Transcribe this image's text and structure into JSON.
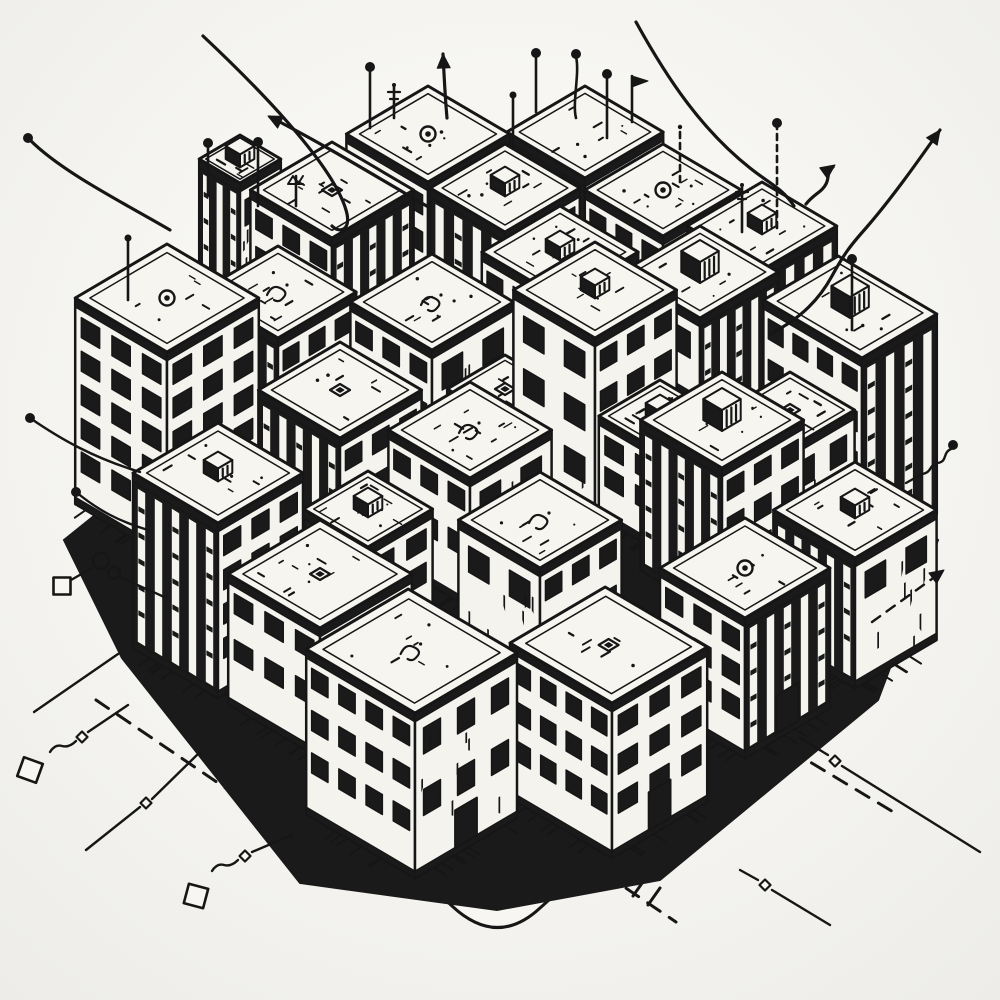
{
  "scene": {
    "label": "hand-drawn isometric city block illustration with antennas, arrows and circuit traces",
    "bg": "#f2f1ed",
    "paper": "#f7f6f2",
    "ink": "#161616",
    "roof": "#f6f5f0",
    "face": "#f4f3ee",
    "dark": "#1a1a1a"
  },
  "iso": {
    "ux": 34,
    "uy": 20
  },
  "ground": {
    "outline": "M 212 424 L 96 520 Q 66 544 84 566 L 452 906 Q 497 948 540 908 L 900 586 Q 928 562 906 538 L 790 430 L 500 300 Z",
    "inner": "M 238 448 L 118 540 Q 98 556 112 570 L 458 886 Q 497 920 534 888 L 876 592 Q 896 570 878 552 L 762 448",
    "mass": "M 500 238 L 706 352 L 938 540 L 878 700 L 660 880 L 497 910 L 300 883 L 122 658 L 64 540 L 298 352 Z",
    "dashes": [
      {
        "d": "M 96 700 L 252 806",
        "w": 3,
        "dash": "15 11"
      },
      {
        "d": "M 128 648 L 188 690",
        "w": 3,
        "dash": "13 10"
      },
      {
        "d": "M 540 830 L 676 922",
        "w": 3,
        "dash": "15 11"
      },
      {
        "d": "M 700 696 L 900 816",
        "w": 3,
        "dash": "15 11"
      },
      {
        "d": "M 212 652 L 468 890",
        "w": 2.6,
        "dash": "18 12"
      },
      {
        "d": "M 806 648 L 532 884",
        "w": 2.6,
        "dash": "18 12"
      },
      {
        "d": "M 452 776 L 486 796",
        "w": 2.6,
        "dash": "9 7"
      },
      {
        "d": "M 462 792 L 496 812",
        "w": 2.6,
        "dash": "9 7"
      }
    ],
    "crosswalk": [
      [
        600,
        852,
        588,
        869
      ],
      [
        615,
        861,
        603,
        878
      ],
      [
        630,
        870,
        618,
        887
      ],
      [
        645,
        879,
        633,
        896
      ],
      [
        660,
        888,
        648,
        905
      ]
    ]
  },
  "buildings": [
    {
      "fx": 428,
      "fy": 332,
      "wa": 2.4,
      "wb": 2.4,
      "h": 150,
      "right": "stripes",
      "left": "grid",
      "roof": "vent",
      "door": false
    },
    {
      "fx": 585,
      "fy": 318,
      "wa": 2.3,
      "wb": 2.3,
      "h": 140,
      "right": "grid",
      "left": "stripes",
      "roof": "none",
      "door": false
    },
    {
      "fx": 240,
      "fy": 303,
      "wa": 1.2,
      "wb": 1.2,
      "h": 120,
      "right": "sparse",
      "left": "stripes",
      "roof": "cube",
      "door": false
    },
    {
      "fx": 332,
      "fy": 388,
      "wa": 2.4,
      "wb": 2.4,
      "h": 150,
      "right": "stripes",
      "left": "grid",
      "roof": "dot",
      "door": false
    },
    {
      "fx": 505,
      "fy": 392,
      "wa": 2.2,
      "wb": 2.2,
      "h": 160,
      "right": "grid",
      "left": "stripes",
      "roof": "cube",
      "door": false
    },
    {
      "fx": 663,
      "fy": 376,
      "wa": 2.3,
      "wb": 2.3,
      "h": 140,
      "right": "sparse",
      "left": "grid",
      "roof": "vent",
      "door": false
    },
    {
      "fx": 762,
      "fy": 420,
      "wa": 2.2,
      "wb": 2.2,
      "h": 150,
      "right": "stripes",
      "left": "stripes",
      "roof": "cube",
      "door": false
    },
    {
      "fx": 167,
      "fy": 558,
      "wa": 2.7,
      "wb": 2.7,
      "h": 206,
      "right": "grid",
      "left": "grid",
      "roof": "vent",
      "door": false
    },
    {
      "fx": 278,
      "fy": 468,
      "wa": 2.3,
      "wb": 2.3,
      "h": 130,
      "right": "grid",
      "left": "stripes",
      "roof": "squiggle",
      "door": false
    },
    {
      "fx": 432,
      "fy": 470,
      "wa": 2.4,
      "wb": 2.4,
      "h": 120,
      "right": "sparse",
      "left": "grid",
      "roof": "squiggle",
      "door": false
    },
    {
      "fx": 560,
      "fy": 448,
      "wa": 2.3,
      "wb": 2.3,
      "h": 150,
      "right": "grid",
      "left": "grid",
      "roof": "cube",
      "door": false
    },
    {
      "fx": 700,
      "fy": 478,
      "wa": 2.3,
      "wb": 2.3,
      "h": 160,
      "right": "stripes",
      "left": "sparse",
      "roof": "cube2",
      "door": false
    },
    {
      "fx": 862,
      "fy": 558,
      "wa": 2.9,
      "wb": 2.2,
      "h": 200,
      "right": "stripes",
      "left": "grid",
      "roof": "cube2",
      "door": false
    },
    {
      "fx": 595,
      "fy": 538,
      "wa": 2.4,
      "wb": 2.4,
      "h": 200,
      "right": "grid",
      "left": "sparse",
      "roof": "cube",
      "door": false
    },
    {
      "fx": 340,
      "fy": 558,
      "wa": 2.4,
      "wb": 2.4,
      "h": 120,
      "right": "grid",
      "left": "stripes",
      "roof": "dot",
      "door": false
    },
    {
      "fx": 470,
      "fy": 608,
      "wa": 2.4,
      "wb": 2.4,
      "h": 130,
      "right": "sparse",
      "left": "grid",
      "roof": "squiggle",
      "door": false
    },
    {
      "fx": 722,
      "fy": 618,
      "wa": 2.4,
      "wb": 2.4,
      "h": 150,
      "right": "grid",
      "left": "stripes",
      "roof": "cube2",
      "door": false
    },
    {
      "fx": 218,
      "fy": 698,
      "wa": 2.5,
      "wb": 2.5,
      "h": 175,
      "right": "grid",
      "left": "stripes",
      "roof": "cube",
      "door": false
    },
    {
      "fx": 320,
      "fy": 758,
      "wa": 2.7,
      "wb": 2.7,
      "h": 130,
      "right": "grid",
      "left": "grid",
      "roof": "dot",
      "door": true
    },
    {
      "fx": 415,
      "fy": 878,
      "wa": 3.2,
      "wb": 3.0,
      "h": 165,
      "right": "sparse",
      "left": "grid",
      "roof": "squiggle",
      "door": true
    },
    {
      "fx": 540,
      "fy": 698,
      "wa": 2.4,
      "wb": 2.4,
      "h": 130,
      "right": "grid",
      "left": "sparse",
      "roof": "squiggle",
      "door": false
    },
    {
      "fx": 612,
      "fy": 858,
      "wa": 3.0,
      "wb": 2.8,
      "h": 155,
      "right": "grid",
      "left": "grid",
      "roof": "dot",
      "door": true
    },
    {
      "fx": 745,
      "fy": 758,
      "wa": 2.5,
      "wb": 2.5,
      "h": 140,
      "right": "stripes",
      "left": "grid",
      "roof": "vent",
      "door": true
    },
    {
      "fx": 855,
      "fy": 688,
      "wa": 2.4,
      "wb": 2.4,
      "h": 130,
      "right": "sparse",
      "left": "stripes",
      "roof": "cube",
      "door": false
    },
    {
      "fx": 660,
      "fy": 552,
      "wa": 1.8,
      "wb": 1.8,
      "h": 100,
      "right": "grid",
      "left": "grid",
      "roof": "cube",
      "door": false
    },
    {
      "fx": 505,
      "fy": 518,
      "wa": 1.7,
      "wb": 1.7,
      "h": 95,
      "right": "stripes",
      "left": "grid",
      "roof": "dot",
      "door": false
    },
    {
      "fx": 368,
      "fy": 652,
      "wa": 1.9,
      "wb": 1.9,
      "h": 105,
      "right": "grid",
      "left": "stripes",
      "roof": "cube",
      "door": false
    },
    {
      "fx": 790,
      "fy": 560,
      "wa": 1.9,
      "wb": 1.9,
      "h": 112,
      "right": "sparse",
      "left": "grid",
      "roof": "dot",
      "door": false
    }
  ],
  "antennas": [
    {
      "x": 370,
      "top": 70,
      "bottom": 128,
      "style": "ball"
    },
    {
      "x": 536,
      "top": 56,
      "bottom": 112,
      "style": "ball"
    },
    {
      "x": 576,
      "top": 57,
      "bottom": 118,
      "style": "ballwave"
    },
    {
      "x": 513,
      "top": 97,
      "bottom": 148,
      "style": "ballsmall"
    },
    {
      "x": 607,
      "top": 77,
      "bottom": 138,
      "style": "ball"
    },
    {
      "x": 680,
      "top": 129,
      "bottom": 182,
      "style": "dash"
    },
    {
      "x": 777,
      "top": 126,
      "bottom": 228,
      "style": "dashball"
    },
    {
      "x": 852,
      "top": 262,
      "bottom": 330,
      "style": "ball"
    },
    {
      "x": 208,
      "top": 146,
      "bottom": 196,
      "style": "ball"
    },
    {
      "x": 258,
      "top": 145,
      "bottom": 206,
      "style": "ball"
    },
    {
      "x": 128,
      "top": 240,
      "bottom": 300,
      "style": "ballsmall"
    },
    {
      "x": 394,
      "top": 86,
      "bottom": 118,
      "style": "cross"
    },
    {
      "x": 632,
      "top": 76,
      "bottom": 122,
      "style": "flag"
    },
    {
      "x": 742,
      "top": 186,
      "bottom": 232,
      "style": "cross"
    },
    {
      "x": 296,
      "top": 176,
      "bottom": 206,
      "style": "tv"
    }
  ],
  "arrows": [
    {
      "d": "M 770 334 C 802 318 820 298 832 276 C 844 254 850 246 866 228 C 892 198 916 164 940 130",
      "head": [
        940,
        130,
        24,
        -34
      ]
    },
    {
      "d": "M 447 118 C 445 96 444 74 443 54",
      "head": [
        443,
        54,
        -1,
        -20
      ]
    },
    {
      "d": "M 430 208 C 382 180 320 142 270 117",
      "head": [
        268,
        116,
        -50,
        -25
      ]
    },
    {
      "d": "M 806 204 C 814 194 822 192 826 184 C 830 176 826 172 833 167",
      "head": [
        835,
        165,
        7,
        -5
      ]
    },
    {
      "d": "M 203 36 C 252 82 332 162 346 210 C 352 230 340 234 332 226",
      "head": null
    },
    {
      "d": "M 636 22 C 668 80 702 130 750 168 C 770 184 782 188 794 206",
      "head": null
    },
    {
      "d": "M 30 140 C 62 172 122 202 170 230",
      "head": null,
      "ball": [
        28,
        138
      ]
    }
  ],
  "traces": {
    "paths": [
      {
        "d": "M 30 418 C 62 440 94 458 140 472"
      },
      {
        "d": "M 76 492 C 98 510 118 521 148 530"
      },
      {
        "d": "M 120 577 C 138 586 150 590 164 597"
      },
      {
        "d": "M 71 580 L 92 568"
      },
      {
        "d": "M 118 654 L 34 712"
      },
      {
        "d": "M 128 705 L 88 732"
      },
      {
        "d": "M 76 741 q -7 7 -14 5 q -7 -2 -12 6"
      },
      {
        "d": "M 200 752 L 152 799"
      },
      {
        "d": "M 140 807 L 86 850"
      },
      {
        "d": "M 292 835 L 252 852"
      },
      {
        "d": "M 238 860 q -7 7 -14 5 q -7 -2 -12 6"
      },
      {
        "d": "M 800 738 L 828 755"
      },
      {
        "d": "M 842 766 L 980 852"
      },
      {
        "d": "M 740 870 L 758 880"
      },
      {
        "d": "M 772 890 L 830 925"
      },
      {
        "d": "M 951 449 C 942 453 948 461 938 463 C 928 465 933 472 922 474 L 906 483"
      },
      {
        "d": "M 872 622 L 936 576",
        "dash": "10 8",
        "head": [
          944,
          570,
          30,
          -22
        ]
      }
    ],
    "balls": [
      [
        30,
        418
      ],
      [
        76,
        492
      ],
      [
        953,
        445
      ]
    ],
    "beads": [
      [
        82,
        737
      ],
      [
        146,
        803
      ],
      [
        245,
        856
      ],
      [
        835,
        761
      ],
      [
        765,
        885
      ]
    ],
    "pads": [
      [
        30,
        770,
        20,
        20
      ],
      [
        196,
        896,
        20,
        15
      ],
      [
        62,
        586,
        17,
        0
      ]
    ],
    "coils": [
      [
        101,
        561,
        8
      ],
      [
        114,
        573,
        6
      ]
    ]
  }
}
